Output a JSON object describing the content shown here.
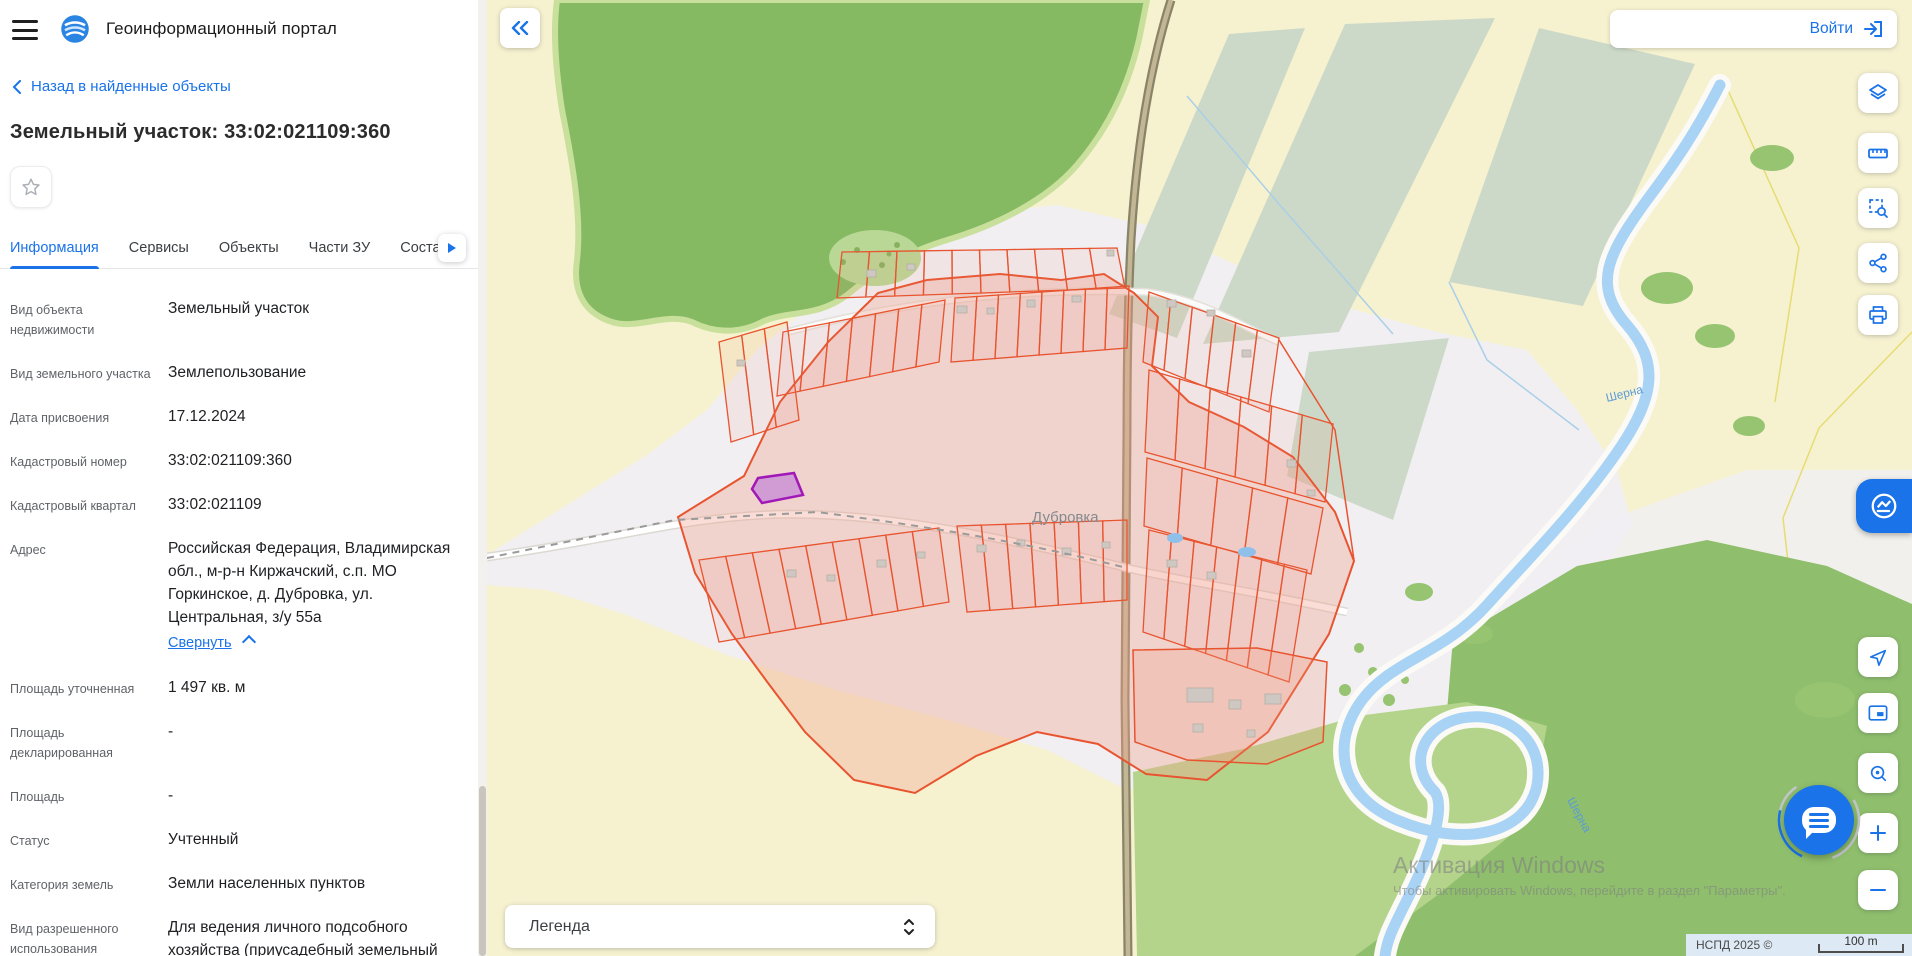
{
  "header": {
    "title": "Геоинформационный портал"
  },
  "back_link": "Назад в найденные объекты",
  "object_title": "Земельный участок: 33:02:021109:360",
  "tabs": [
    {
      "label": "Информация",
      "active": true
    },
    {
      "label": "Сервисы",
      "active": false
    },
    {
      "label": "Объекты",
      "active": false
    },
    {
      "label": "Части ЗУ",
      "active": false
    },
    {
      "label": "Соста",
      "active": false,
      "cut": true
    }
  ],
  "fields": [
    {
      "label": "Вид объекта недвижимости",
      "value": "Земельный участок"
    },
    {
      "label": "Вид земельного участка",
      "value": "Землепользование"
    },
    {
      "label": "Дата присвоения",
      "value": "17.12.2024"
    },
    {
      "label": "Кадастровый номер",
      "value": "33:02:021109:360"
    },
    {
      "label": "Кадастровый квартал",
      "value": "33:02:021109"
    },
    {
      "label": "Адрес",
      "value": "Российская Федерация, Владимирская обл., м-р-н Киржачский, с.п. МО Горкинское, д. Дубровка, ул. Центральная, з/у 55а",
      "link": "Свернуть"
    },
    {
      "label": "Площадь уточненная",
      "value": "1 497 кв. м"
    },
    {
      "label": "Площадь декларированная",
      "value": "-"
    },
    {
      "label": "Площадь",
      "value": "-"
    },
    {
      "label": "Статус",
      "value": "Учтенный"
    },
    {
      "label": "Категория земель",
      "value": "Земли населенных пунктов"
    },
    {
      "label": "Вид разрешенного использования",
      "value": "Для ведения личного подсобного хозяйства (приусадебный земельный участок)"
    }
  ],
  "login": {
    "label": "Войти"
  },
  "toolbar": [
    {
      "icon": "layers-icon"
    },
    {
      "icon": "ruler-icon"
    },
    {
      "icon": "area-search-icon"
    },
    {
      "icon": "share-icon"
    },
    {
      "icon": "print-icon"
    }
  ],
  "map": {
    "place_label": "Дубровка",
    "river_label": "Шерна",
    "legend_label": "Легенда",
    "attribution": "НСПД 2025 ©",
    "scale_label": "100 m",
    "watermark_title": "Активация Windows",
    "watermark_sub": "Чтобы активировать Windows, перейдите в раздел \"Параметры\"."
  },
  "colors": {
    "accent": "#1a73e8",
    "parcel_stroke": "#e8542f",
    "quarter_fill": "rgba(242,166,147,0.35)",
    "selected_fill": "#c98fd6",
    "selected_stroke": "#a118b8",
    "forest": "#85ba62",
    "meadow": "#b4d48c",
    "water": "#a9d3f4"
  }
}
